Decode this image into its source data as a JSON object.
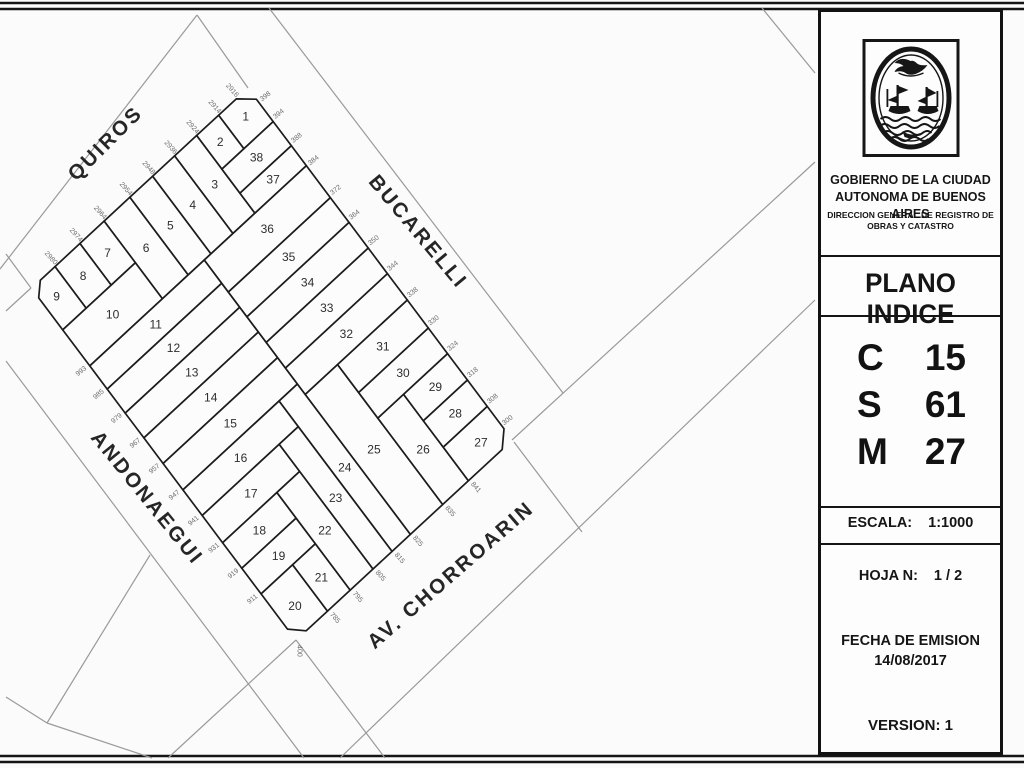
{
  "page": {
    "bg": "#fbfbfb",
    "ink": "#1c1c1c",
    "street_line_color": "#9a9a9a",
    "parcel_fill": "#fcfcfc",
    "label_color": "#2e2e2e",
    "dim_color": "#6e6e6e"
  },
  "panel": {
    "escudo_icon": "coat-of-arms-buenos-aires",
    "org_line1": "GOBIERNO DE LA CIUDAD",
    "org_line2": "AUTONOMA DE BUENOS AIRES",
    "org_line3": "DIRECCION GENERAL DE REGISTRO DE",
    "org_line4": "OBRAS Y CATASTRO",
    "title": "PLANO INDICE",
    "codes": [
      {
        "label": "C",
        "value": "15"
      },
      {
        "label": "S",
        "value": "61"
      },
      {
        "label": "M",
        "value": "27"
      }
    ],
    "escala_label": "ESCALA:",
    "escala_value": "1:1000",
    "hoja_label": "HOJA N:",
    "hoja_value": "1 / 2",
    "fecha_label": "FECHA DE EMISION",
    "fecha_value": "14/08/2017",
    "version": "VERSION: 1"
  },
  "map": {
    "frame": {
      "ox": 248,
      "oy": 88,
      "ux": -0.734,
      "uy": 0.679,
      "vx": 0.601,
      "vy": 0.8
    },
    "streets": [
      {
        "id": "quiros",
        "name": "QUIROS",
        "x": 110,
        "y": 148,
        "rot": -45
      },
      {
        "id": "bucarelli",
        "name": "BUCARELLI",
        "x": 413,
        "y": 236,
        "rot": 50
      },
      {
        "id": "andonaegui",
        "name": "ANDONAEGUI",
        "x": 142,
        "y": 502,
        "rot": 51
      },
      {
        "id": "chorroarin",
        "name": "AV. CHORROARIN",
        "x": 455,
        "y": 580,
        "rot": -41
      }
    ],
    "parcels": [
      {
        "n": "1",
        "pts": [
          [
            16,
            0
          ],
          [
            40,
            0
          ],
          [
            40,
            42
          ],
          [
            0,
            42
          ],
          [
            0,
            14
          ]
        ]
      },
      {
        "n": "2",
        "pts": [
          [
            40,
            0
          ],
          [
            70,
            0
          ],
          [
            70,
            42
          ],
          [
            40,
            42
          ]
        ]
      },
      {
        "n": "3",
        "pts": [
          [
            70,
            0
          ],
          [
            100,
            0
          ],
          [
            100,
            97
          ],
          [
            70,
            97
          ]
        ]
      },
      {
        "n": "4",
        "pts": [
          [
            100,
            0
          ],
          [
            130,
            0
          ],
          [
            130,
            97
          ],
          [
            100,
            97
          ]
        ]
      },
      {
        "n": "5",
        "pts": [
          [
            130,
            0
          ],
          [
            161,
            0
          ],
          [
            161,
            97
          ],
          [
            130,
            97
          ]
        ]
      },
      {
        "n": "6",
        "pts": [
          [
            161,
            0
          ],
          [
            196,
            0
          ],
          [
            196,
            97
          ],
          [
            161,
            97
          ]
        ]
      },
      {
        "n": "7",
        "pts": [
          [
            196,
            0
          ],
          [
            229,
            0
          ],
          [
            229,
            52
          ],
          [
            196,
            52
          ]
        ]
      },
      {
        "n": "8",
        "pts": [
          [
            229,
            0
          ],
          [
            263,
            0
          ],
          [
            263,
            52
          ],
          [
            229,
            52
          ]
        ]
      },
      {
        "n": "9",
        "pts": [
          [
            263,
            0
          ],
          [
            283,
            0
          ],
          [
            295,
            12
          ],
          [
            295,
            52
          ],
          [
            263,
            52
          ]
        ]
      },
      {
        "n": "10",
        "pts": [
          [
            196,
            52
          ],
          [
            295,
            52
          ],
          [
            295,
            97
          ],
          [
            196,
            97
          ]
        ]
      },
      {
        "n": "11",
        "pts": [
          [
            139,
            97
          ],
          [
            295,
            97
          ],
          [
            295,
            126
          ],
          [
            139,
            126
          ]
        ]
      },
      {
        "n": "12",
        "pts": [
          [
            139,
            126
          ],
          [
            295,
            126
          ],
          [
            295,
            156
          ],
          [
            139,
            156
          ]
        ]
      },
      {
        "n": "13",
        "pts": [
          [
            139,
            156
          ],
          [
            295,
            156
          ],
          [
            295,
            187
          ],
          [
            139,
            187
          ]
        ]
      },
      {
        "n": "14",
        "pts": [
          [
            139,
            187
          ],
          [
            295,
            187
          ],
          [
            295,
            219
          ],
          [
            139,
            219
          ]
        ]
      },
      {
        "n": "15",
        "pts": [
          [
            139,
            219
          ],
          [
            295,
            219
          ],
          [
            295,
            252
          ],
          [
            139,
            252
          ]
        ]
      },
      {
        "n": "16",
        "pts": [
          [
            164,
            252
          ],
          [
            295,
            252
          ],
          [
            295,
            284
          ],
          [
            164,
            284
          ]
        ]
      },
      {
        "n": "17",
        "pts": [
          [
            190,
            284
          ],
          [
            295,
            284
          ],
          [
            295,
            318
          ],
          [
            190,
            318
          ]
        ]
      },
      {
        "n": "18",
        "pts": [
          [
            221,
            318
          ],
          [
            295,
            318
          ],
          [
            295,
            350
          ],
          [
            221,
            350
          ]
        ]
      },
      {
        "n": "19",
        "pts": [
          [
            221,
            350
          ],
          [
            295,
            350
          ],
          [
            295,
            382
          ],
          [
            221,
            382
          ]
        ]
      },
      {
        "n": "20",
        "pts": [
          [
            252,
            382
          ],
          [
            295,
            382
          ],
          [
            295,
            426
          ],
          [
            281,
            440
          ],
          [
            252,
            440
          ]
        ]
      },
      {
        "n": "21",
        "pts": [
          [
            221,
            382
          ],
          [
            252,
            382
          ],
          [
            252,
            440
          ],
          [
            221,
            440
          ]
        ]
      },
      {
        "n": "22",
        "pts": [
          [
            190,
            318
          ],
          [
            221,
            318
          ],
          [
            221,
            440
          ],
          [
            190,
            440
          ]
        ]
      },
      {
        "n": "23",
        "pts": [
          [
            164,
            284
          ],
          [
            190,
            284
          ],
          [
            190,
            440
          ],
          [
            164,
            440
          ]
        ]
      },
      {
        "n": "24",
        "pts": [
          [
            139,
            252
          ],
          [
            164,
            252
          ],
          [
            164,
            440
          ],
          [
            139,
            440
          ]
        ]
      },
      {
        "n": "25",
        "pts": [
          [
            95,
            265
          ],
          [
            139,
            265
          ],
          [
            139,
            440
          ],
          [
            95,
            440
          ]
        ]
      },
      {
        "n": "26",
        "pts": [
          [
            60,
            332
          ],
          [
            95,
            332
          ],
          [
            95,
            440
          ],
          [
            60,
            440
          ]
        ]
      },
      {
        "n": "27",
        "pts": [
          [
            0,
            398
          ],
          [
            60,
            398
          ],
          [
            60,
            440
          ],
          [
            14,
            440
          ],
          [
            0,
            426
          ]
        ]
      },
      {
        "n": "28",
        "pts": [
          [
            0,
            365
          ],
          [
            60,
            365
          ],
          [
            60,
            398
          ],
          [
            0,
            398
          ]
        ]
      },
      {
        "n": "29",
        "pts": [
          [
            0,
            332
          ],
          [
            60,
            332
          ],
          [
            60,
            365
          ],
          [
            0,
            365
          ]
        ]
      },
      {
        "n": "30",
        "pts": [
          [
            0,
            300
          ],
          [
            95,
            300
          ],
          [
            95,
            332
          ],
          [
            0,
            332
          ]
        ]
      },
      {
        "n": "31",
        "pts": [
          [
            0,
            265
          ],
          [
            95,
            265
          ],
          [
            95,
            300
          ],
          [
            0,
            300
          ]
        ]
      },
      {
        "n": "32",
        "pts": [
          [
            0,
            232
          ],
          [
            139,
            232
          ],
          [
            139,
            265
          ],
          [
            0,
            265
          ]
        ]
      },
      {
        "n": "33",
        "pts": [
          [
            0,
            200
          ],
          [
            139,
            200
          ],
          [
            139,
            232
          ],
          [
            0,
            232
          ]
        ]
      },
      {
        "n": "34",
        "pts": [
          [
            0,
            168
          ],
          [
            139,
            168
          ],
          [
            139,
            200
          ],
          [
            0,
            200
          ]
        ]
      },
      {
        "n": "35",
        "pts": [
          [
            0,
            137
          ],
          [
            139,
            137
          ],
          [
            139,
            168
          ],
          [
            0,
            168
          ]
        ]
      },
      {
        "n": "36",
        "pts": [
          [
            0,
            97
          ],
          [
            139,
            97
          ],
          [
            139,
            137
          ],
          [
            0,
            137
          ]
        ]
      },
      {
        "n": "37",
        "pts": [
          [
            0,
            72
          ],
          [
            70,
            72
          ],
          [
            70,
            97
          ],
          [
            0,
            97
          ]
        ]
      },
      {
        "n": "38",
        "pts": [
          [
            0,
            42
          ],
          [
            70,
            42
          ],
          [
            70,
            72
          ],
          [
            0,
            72
          ]
        ]
      }
    ],
    "edge_numbers": [
      {
        "v": "2916",
        "s": 16,
        "t": -9,
        "r": 48
      },
      {
        "v": "2914",
        "s": 40,
        "t": -9,
        "r": 48
      },
      {
        "v": "2924",
        "s": 70,
        "t": -9,
        "r": 48
      },
      {
        "v": "2936",
        "s": 100,
        "t": -9,
        "r": 48
      },
      {
        "v": "2948",
        "s": 130,
        "t": -9,
        "r": 48
      },
      {
        "v": "2954",
        "s": 161,
        "t": -9,
        "r": 48
      },
      {
        "v": "2964",
        "s": 196,
        "t": -9,
        "r": 48
      },
      {
        "v": "2974",
        "s": 229,
        "t": -9,
        "r": 48
      },
      {
        "v": "2980",
        "s": 263,
        "t": -9,
        "r": 48
      },
      {
        "v": "398",
        "s": -9,
        "t": 20,
        "r": -38
      },
      {
        "v": "394",
        "s": -9,
        "t": 42,
        "r": -38
      },
      {
        "v": "388",
        "s": -9,
        "t": 72,
        "r": -38
      },
      {
        "v": "384",
        "s": -9,
        "t": 100,
        "r": -38
      },
      {
        "v": "372",
        "s": -9,
        "t": 137,
        "r": -38
      },
      {
        "v": "364",
        "s": -9,
        "t": 168,
        "r": -38
      },
      {
        "v": "350",
        "s": -9,
        "t": 200,
        "r": -38
      },
      {
        "v": "344",
        "s": -9,
        "t": 232,
        "r": -38
      },
      {
        "v": "338",
        "s": -9,
        "t": 265,
        "r": -38
      },
      {
        "v": "330",
        "s": -9,
        "t": 300,
        "r": -38
      },
      {
        "v": "324",
        "s": -9,
        "t": 332,
        "r": -38
      },
      {
        "v": "318",
        "s": -9,
        "t": 365,
        "r": -38
      },
      {
        "v": "308",
        "s": -9,
        "t": 398,
        "r": -38
      },
      {
        "v": "300",
        "s": -8,
        "t": 424,
        "r": -38
      },
      {
        "v": "993",
        "s": 305,
        "t": 97,
        "r": -39
      },
      {
        "v": "985",
        "s": 305,
        "t": 126,
        "r": -39
      },
      {
        "v": "979",
        "s": 305,
        "t": 156,
        "r": -39
      },
      {
        "v": "967",
        "s": 305,
        "t": 187,
        "r": -39
      },
      {
        "v": "957",
        "s": 305,
        "t": 219,
        "r": -39
      },
      {
        "v": "947",
        "s": 305,
        "t": 252,
        "r": -39
      },
      {
        "v": "941",
        "s": 305,
        "t": 284,
        "r": -39
      },
      {
        "v": "931",
        "s": 305,
        "t": 318,
        "r": -39
      },
      {
        "v": "919",
        "s": 305,
        "t": 350,
        "r": -39
      },
      {
        "v": "911",
        "s": 305,
        "t": 382,
        "r": -39
      },
      {
        "v": "841",
        "s": 60,
        "t": 450,
        "r": 49
      },
      {
        "v": "835",
        "s": 95,
        "t": 450,
        "r": 49
      },
      {
        "v": "825",
        "s": 139,
        "t": 450,
        "r": 49
      },
      {
        "v": "815",
        "s": 164,
        "t": 450,
        "r": 49
      },
      {
        "v": "805",
        "s": 190,
        "t": 450,
        "r": 49
      },
      {
        "v": "795",
        "s": 221,
        "t": 450,
        "r": 49
      },
      {
        "v": "785",
        "s": 252,
        "t": 450,
        "r": 49
      },
      {
        "v": "400",
        "s": 300,
        "t": 449,
        "r": 90
      }
    ],
    "periphery": [
      [
        0,
        269,
        197,
        15
      ],
      [
        197,
        15,
        248,
        88
      ],
      [
        269,
        8,
        563,
        393
      ],
      [
        512,
        440,
        815,
        162
      ],
      [
        762,
        8,
        815,
        73
      ],
      [
        340,
        758,
        815,
        300
      ],
      [
        514,
        442,
        582,
        532
      ],
      [
        31,
        288,
        6,
        311
      ],
      [
        31,
        288,
        6,
        254
      ],
      [
        6,
        361,
        304,
        758
      ],
      [
        150,
        555,
        47,
        723
      ],
      [
        47,
        723,
        152,
        758
      ],
      [
        47,
        723,
        6,
        697
      ],
      [
        296,
        640,
        385,
        758
      ],
      [
        296,
        640,
        168,
        758
      ]
    ],
    "borders": [
      [
        0,
        3,
        1024,
        3
      ],
      [
        0,
        9,
        1024,
        9
      ],
      [
        0,
        756,
        1024,
        756
      ],
      [
        0,
        762,
        1024,
        762
      ]
    ]
  }
}
